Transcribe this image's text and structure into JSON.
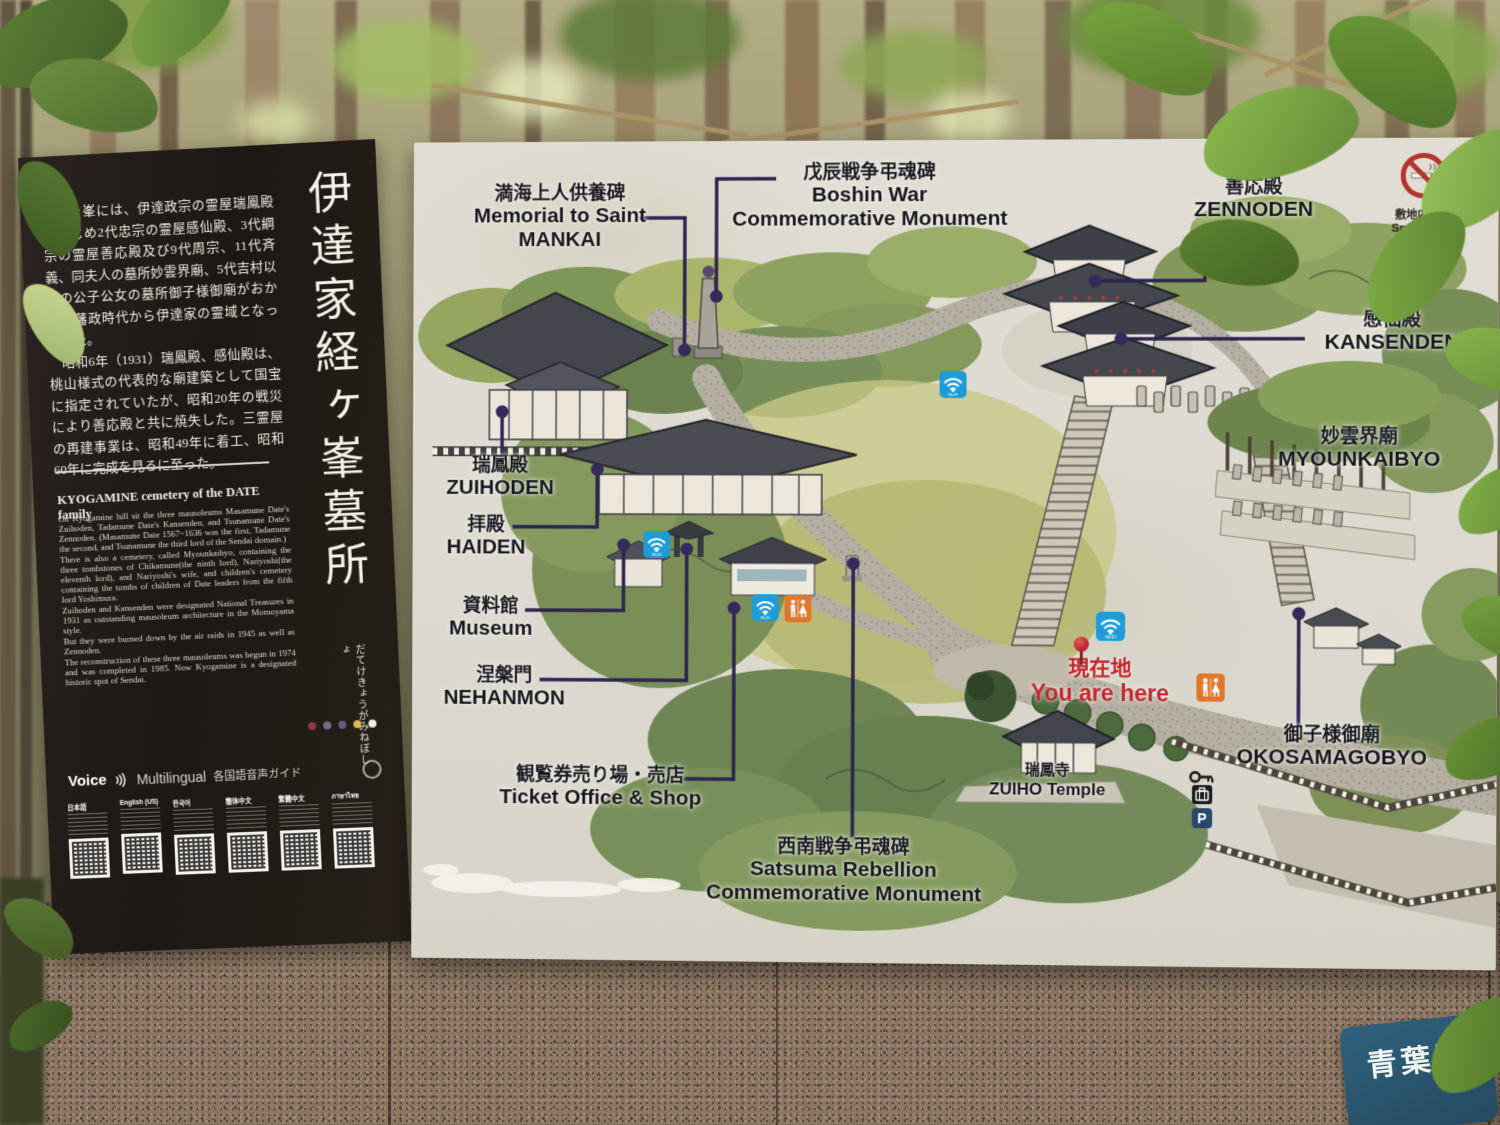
{
  "left_panel": {
    "title_vertical": "伊達家経ヶ峯墓所",
    "title_reading": "だてけきょうがみねぼしょ",
    "jp_paragraphs": [
      "経ヶ峯には、伊達政宗の霊屋瑞鳳殿をはじめ2代忠宗の霊屋感仙殿、3代綱宗の霊屋善応殿及び9代周宗、11代斉義、同夫人の墓所妙雲界廟、5代吉村以下の公子公女の墓所御子様御廟がおかれ、藩政時代から伊達家の霊域となっていた。",
      "昭和6年（1931）瑞鳳殿、感仙殿は、桃山様式の代表的な廟建築として国宝に指定されていたが、昭和20年の戦災により善応殿と共に焼失した。三霊屋の再建事業は、昭和49年に着工、昭和60年に完成を見るに至った。"
    ],
    "en_heading": "KYOGAMINE cemetery of the DATE family",
    "en_paragraphs": [
      "On Kyogamine hill sit the three mausoleums Masamune Date's Zuihoden, Tadamune Date's Kansenden, and Tsunamune Date's Zennoden. (Masamune Date 1567~1636 was the first, Tadamune the second, and Tsunamune the third lord of the Sendai domain.)",
      "There is also a cemetery, called Myounkaibyo, containing the three tombstones of Chikamune(the ninth lord), Nariyoshi(the eleventh lord), and Nariyoshi's wife, and children's cemetery containing the tombs of children of Date leaders from the fifth lord Yoshimura.",
      "Zuihoden and Kansenden were designated National Treasures in 1931 as outstanding mausoleum architecture in the Momoyama style.",
      "But they were burned down by the air raids in 1945 as well as Zennoden.",
      "The reconstruction of these three mausoleums was begun in 1974 and was completed in 1985. Now Kyogamine is a designated historic spot of Sendai."
    ],
    "voice": {
      "voice": "Voice",
      "multilingual": "Multilingual",
      "guide_jp": "各国語音声ガイド"
    },
    "qr_languages": [
      "日本語",
      "English (US)",
      "한국어",
      "簡体中文",
      "繁體中文",
      "ภาษาไทย"
    ],
    "title_dots": [
      "#8e3948",
      "#6b7280",
      "#5b5f8a",
      "#d8b94a",
      "#efece2"
    ]
  },
  "map_board": {
    "labels": {
      "mankai": {
        "jp": "満海上人供養碑",
        "en": "Memorial to Saint\nMANKAI"
      },
      "boshin": {
        "jp": "戊辰戦争弔魂碑",
        "en": "Boshin War\nCommemorative Monument"
      },
      "zennoden": {
        "jp": "善応殿",
        "en": "ZENNODEN"
      },
      "kansenden": {
        "jp": "感仙殿",
        "en": "KANSENDEN"
      },
      "myounkaibyo": {
        "jp": "妙雲界廟",
        "en": "MYOUNKAIBYO"
      },
      "zuihoden": {
        "jp": "瑞鳳殿",
        "en": "ZUIHODEN"
      },
      "haiden": {
        "jp": "拝殿",
        "en": "HAIDEN"
      },
      "museum": {
        "jp": "資料館",
        "en": "Museum"
      },
      "nehanmon": {
        "jp": "涅槃門",
        "en": "NEHANMON"
      },
      "ticket": {
        "jp": "観覧券売り場・売店",
        "en": "Ticket Office & Shop"
      },
      "satsuma": {
        "jp": "西南戦争弔魂碑",
        "en": "Satsuma Rebellion\nCommemorative Monument"
      },
      "you_are_here": {
        "jp": "現在地",
        "en": "You are here"
      },
      "zuiho_temple": {
        "jp": "瑞鳳寺",
        "en": "ZUIHO Temple"
      },
      "okosamagobyo": {
        "jp": "御子様御廟",
        "en": "OKOSAMAGOBYO"
      },
      "smoke_free": {
        "jp": "敷地内禁煙",
        "en": "Smoke free area"
      }
    },
    "icons": {
      "wifi": "Wi-Fi",
      "parking": "P"
    },
    "colors": {
      "you_are_here_red": "#c0272d",
      "wifi_blue": "#1e9cd7",
      "toilet_orange": "#e0772a",
      "parking_blue": "#27496e",
      "no_smoking_red": "#b5332e",
      "connector_purple": "#2b2350",
      "board_bg": "#dcdad0",
      "panel_bg": "#221c18"
    }
  },
  "exterior": {
    "ward_sign": "青葉区"
  }
}
